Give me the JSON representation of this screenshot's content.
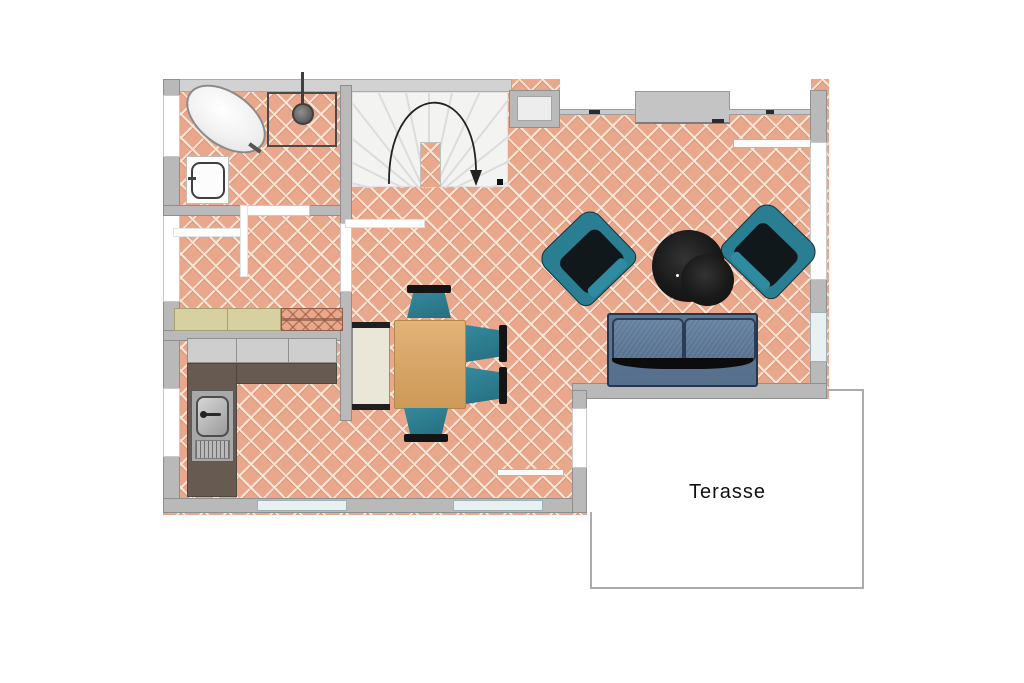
{
  "terrace": {
    "label": "Terasse"
  },
  "palette": {
    "floor_tile": "#e9a78c",
    "tile_line": "#f7e3d3",
    "wall_gray": "#b9b9b9",
    "stair_white": "#f3f3f2",
    "chair_teal": "#2a7e91",
    "sofa_blue": "#5d7795",
    "table_wood": "#d9a76c",
    "kitchen_counter_dark": "#675b51",
    "sideboard_beige": "#d7d0a1",
    "rug_black": "#161616",
    "window_glass": "#e8f0f2"
  }
}
